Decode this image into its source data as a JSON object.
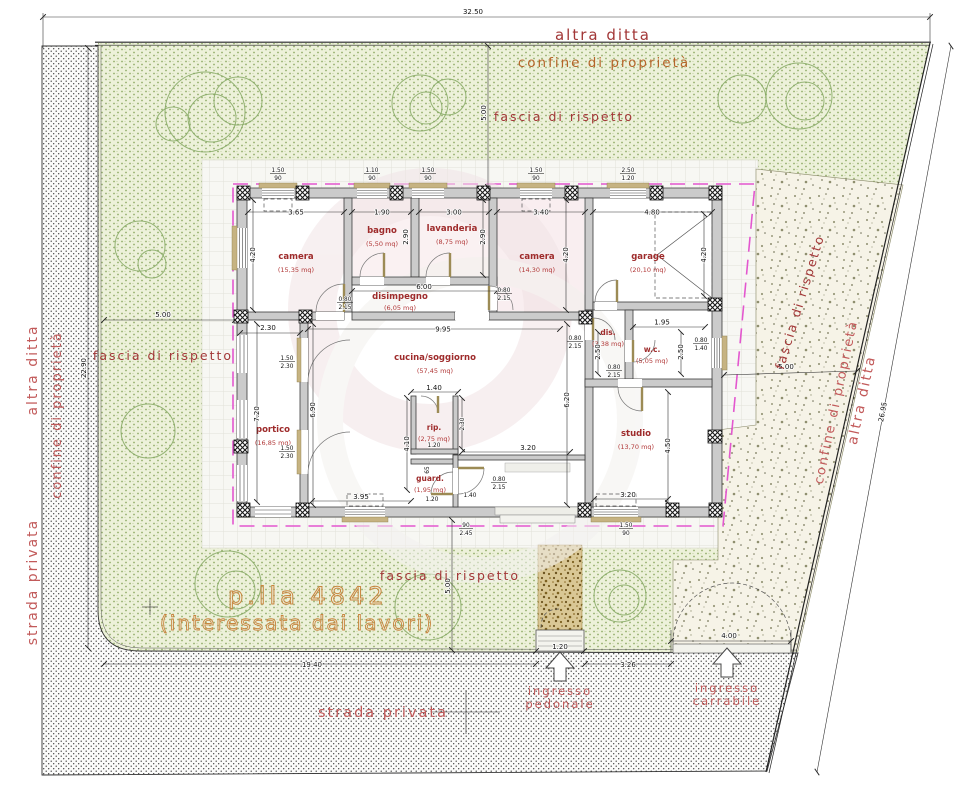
{
  "site_labels": {
    "altra_ditta": "altra ditta",
    "confine_di_proprieta": "confine di proprietà",
    "fascia_di_rispetto": "fascia di rispetto",
    "strada_privata": "strada privata",
    "parcel_title": "p.lla 4842",
    "parcel_subtitle": "(interessata dai lavori)",
    "ingresso_pedonale_1": "ingresso",
    "ingresso_pedonale_2": "pedonale",
    "ingresso_carrabile_1": "ingresso",
    "ingresso_carrabile_2": "carrabile"
  },
  "site_dims": {
    "top_width": "32.50",
    "right_side": "26.95",
    "left_side": "22.90",
    "road_front": "19.40",
    "gate_pedestrian": "1.20",
    "between_gates": "3.26",
    "gate_driveway": "4.00",
    "setback": "5.00"
  },
  "rooms": {
    "camera1": {
      "name": "camera",
      "area": "(15,35 mq)"
    },
    "bagno": {
      "name": "bagno",
      "area": "(5,50 mq)"
    },
    "lavanderia": {
      "name": "lavanderia",
      "area": "(8,75 mq)"
    },
    "camera2": {
      "name": "camera",
      "area": "(14,30 mq)"
    },
    "garage": {
      "name": "garage",
      "area": "(20,10 mq)"
    },
    "disimpegno": {
      "name": "disimpegno",
      "area": "(6,05 mq)"
    },
    "cucina": {
      "name": "cucina/soggiorno",
      "area": "(57,45 mq)"
    },
    "portico": {
      "name": "portico",
      "area": "(16,85 mq)"
    },
    "rip": {
      "name": "rip.",
      "area": "(2,75 mq)"
    },
    "guard": {
      "name": "guard.",
      "area": "(1,95 mq)"
    },
    "dis": {
      "name": "dis.",
      "area": "(3,38 mq)"
    },
    "wc": {
      "name": "w.c.",
      "area": "(5,05 mq)"
    },
    "studio": {
      "name": "studio",
      "area": "(13,70 mq)"
    }
  },
  "room_dims": {
    "camera1_w": "3.65",
    "bagno_w": "1.90",
    "lavanderia_w": "3.00",
    "camera2_w": "3.40",
    "garage_w": "4.80",
    "camera1_d": "4.20",
    "camera2_d": "4.20",
    "garage_d": "4.20",
    "bagno_d": "2.90",
    "lavanderia_d": "2.90",
    "disimpegno_l": "6.00",
    "cucina_w": "9.95",
    "cucina_d": "6.90",
    "portico_w": "2.30",
    "portico_l": "7.20",
    "cucina_bottom": "3.95",
    "rip_top": "1.40",
    "rip_bottom": "1.20",
    "rip_side": "2.30",
    "rip_wall": "4.10",
    "niche_depth": "65",
    "guard_door": "1.40",
    "guard_w": "1.20",
    "wc_w": "1.95",
    "dis_d": "2.50",
    "wc_d": "2.50",
    "studio_wall": "6.20",
    "studio_side": "4.50",
    "studio_w": "3.20",
    "entry_w": "3.20"
  },
  "opening_dims": {
    "door_std_w": "0.80",
    "door_std_h": "2.15",
    "wc_win_w": "0.80",
    "wc_win_h": "1.40",
    "french_w": "1.50",
    "french_h": "2.30",
    "win_a_w": "1.50",
    "win_a_h": "90",
    "win_b_w": "1.10",
    "win_b_h": "90",
    "win_g_w": "2.50",
    "win_g_h": "1.20",
    "entry_door_w": "90",
    "entry_door_h": "2.45"
  },
  "colors": {
    "label_red": "#9e2b2b",
    "site_pink": "#c25a5a",
    "ocra": "#b5652a",
    "magenta": "#e357cf",
    "parcel_orange": "#c8853f",
    "grass_green": "#93ad6b",
    "wall_gray": "#cbcbcb"
  }
}
